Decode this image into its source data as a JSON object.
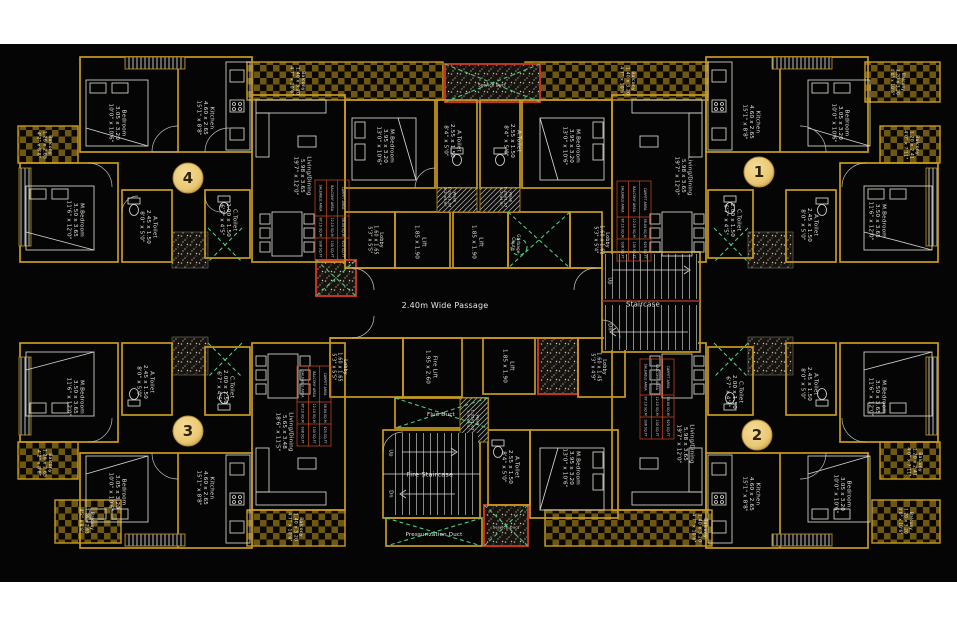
{
  "colors": {
    "canvas": "#050505",
    "wall_gold": "#c89a20",
    "wall_dark": "#8a6614",
    "checker": "#6e5712",
    "accent_red": "#c03522",
    "accent_green": "#4ec97d",
    "badge_fill": "#e9c874",
    "badge_edge": "#b4893a",
    "badge_text": "#30230a",
    "label_text": "#e7e7e1",
    "table_border": "#cf4a1e"
  },
  "badges": [
    {
      "name": "unit-badge-1",
      "label": "1",
      "x": 759,
      "y": 172
    },
    {
      "name": "unit-badge-2",
      "label": "2",
      "x": 757,
      "y": 435
    },
    {
      "name": "unit-badge-3",
      "label": "3",
      "x": 188,
      "y": 431
    },
    {
      "name": "unit-badge-4",
      "label": "4",
      "x": 188,
      "y": 178
    }
  ],
  "labels": [
    {
      "name": "u4-bedroom-label",
      "x": 118,
      "y": 123,
      "rot": 90,
      "lines": [
        "Bedroom",
        "3.05 x 3.20",
        "10'0\" x 10'6\""
      ]
    },
    {
      "name": "u4-kitchen-label",
      "x": 206,
      "y": 118,
      "rot": 90,
      "lines": [
        "Kitchen",
        "4.60 x 2.65",
        "15'1\" x 8'8\""
      ]
    },
    {
      "name": "u4-mbedroom-label",
      "x": 76,
      "y": 220,
      "rot": 90,
      "lines": [
        "M.Bedroom",
        "3.50 x 3.65",
        "11'6\" x 12'0\""
      ]
    },
    {
      "name": "u4-atoilet-label",
      "x": 149,
      "y": 227,
      "rot": 90,
      "lines": [
        "A.Toilet",
        "2.45 x 1.50",
        "8'0\" x 5'0\""
      ]
    },
    {
      "name": "u4-ctoilet-label",
      "x": 229,
      "y": 220,
      "rot": 90,
      "lines": [
        "C.Toilet",
        "2.00 x 1.50",
        "6'7\" x 4'5\""
      ]
    },
    {
      "name": "u4-living-label",
      "x": 303,
      "y": 176,
      "rot": 90,
      "lines": [
        "Living/Dining",
        "5.98 x 3.65",
        "19'7\" x 12'0\""
      ]
    },
    {
      "name": "u4-balcony-left-label",
      "x": 45,
      "y": 145,
      "rot": 90,
      "size": 4.6,
      "lines": [
        "Balcony",
        "1.26 x 2.65",
        "4'2\" x 8'8\""
      ]
    },
    {
      "name": "u4-balcony-top-label",
      "x": 298,
      "y": 81,
      "rot": 90,
      "size": 4.6,
      "lines": [
        "Balcony",
        "1.40 x 3.20",
        "4'7\" x 10'6\""
      ]
    },
    {
      "name": "u4-mbedroom2-label",
      "x": 386,
      "y": 146,
      "rot": 90,
      "lines": [
        "M.Bedroom",
        "3.95 x 3.20",
        "13'0\" x 10'6\""
      ]
    },
    {
      "name": "u4-atoilet2-label",
      "x": 453,
      "y": 141,
      "rot": 90,
      "lines": [
        "A.Toilet",
        "2.55 x 1.50",
        "8'4\" x 5'0\""
      ]
    },
    {
      "name": "wash-top-left-label",
      "x": 450,
      "y": 197,
      "rot": 90,
      "size": 3.8,
      "lines": [
        "Wash",
        "1.20x1.37",
        "4'2\"x4'6\""
      ]
    },
    {
      "name": "wash-top-right-label",
      "x": 506,
      "y": 197,
      "rot": 90,
      "size": 3.8,
      "lines": [
        "Wash",
        "1.20x1.37",
        "4'2\"x4'6\""
      ]
    },
    {
      "name": "lobby-top-left-label",
      "x": 376,
      "y": 240,
      "rot": 90,
      "size": 4.8,
      "lines": [
        "Lobby",
        "1.60 x 1.65",
        "5'3\" x 5'5\""
      ]
    },
    {
      "name": "lift-1-label",
      "x": 421,
      "y": 242,
      "rot": 90,
      "lines": [
        "Lift",
        "1.85 x 1.90"
      ]
    },
    {
      "name": "lift-2-label",
      "x": 478,
      "y": 242,
      "rot": 90,
      "lines": [
        "Lift",
        "1.85 x 1.90"
      ]
    },
    {
      "name": "garbage-chute-label",
      "x": 516,
      "y": 244,
      "rot": 90,
      "size": 4.2,
      "lines": [
        "Garbage",
        "Chute"
      ]
    },
    {
      "name": "lobby-top-right-label",
      "x": 602,
      "y": 240,
      "rot": 90,
      "size": 4.8,
      "lines": [
        "Lobby",
        "1.60 x 1.62",
        "5'3\" x 5'4\""
      ]
    },
    {
      "name": "staircase-label",
      "x": 643,
      "y": 304,
      "rot": 0,
      "size": 7,
      "lines": [
        "Staircase"
      ]
    },
    {
      "name": "staircase-up-label",
      "x": 610,
      "y": 281,
      "rot": 90,
      "size": 5,
      "lines": [
        "Up"
      ]
    },
    {
      "name": "staircase-dn-label",
      "x": 610,
      "y": 327,
      "rot": 90,
      "size": 5,
      "lines": [
        "Dn"
      ]
    },
    {
      "name": "passage-label",
      "x": 445,
      "y": 305,
      "rot": 0,
      "size": 8,
      "lines": [
        "2.40m Wide Passage"
      ]
    },
    {
      "name": "service-duct-top-label",
      "x": 492,
      "y": 85,
      "rot": 0,
      "size": 4,
      "lines": [
        "Service Duct"
      ]
    },
    {
      "name": "u1-kitchen-label",
      "x": 752,
      "y": 122,
      "rot": 90,
      "lines": [
        "Kitchen",
        "4.60 x 2.65",
        "15'1\" x 8'8\""
      ]
    },
    {
      "name": "u1-bedroom-label",
      "x": 841,
      "y": 123,
      "rot": 90,
      "lines": [
        "Bedroom",
        "3.05 x 3.20",
        "10'0\" x 10'6\""
      ]
    },
    {
      "name": "u1-mbedroom-label",
      "x": 878,
      "y": 221,
      "rot": 90,
      "lines": [
        "M.Bedroom",
        "3.50 x 3.65",
        "11'6\" x 12'0\""
      ]
    },
    {
      "name": "u1-atoilet-label",
      "x": 810,
      "y": 225,
      "rot": 90,
      "lines": [
        "A.Toilet",
        "2.45 x 1.50",
        "8'0\" x 5'0\""
      ]
    },
    {
      "name": "u1-ctoilet-label",
      "x": 733,
      "y": 220,
      "rot": 90,
      "lines": [
        "C.Toilet",
        "2.00 x 1.50",
        "6'7\" x 4'5\""
      ]
    },
    {
      "name": "u1-living-label",
      "x": 684,
      "y": 176,
      "rot": 90,
      "lines": [
        "Living/Dining",
        "5.98 x 3.65",
        "19'7\" x 12'0\""
      ]
    },
    {
      "name": "u1-balcony-right-label",
      "x": 912,
      "y": 145,
      "rot": 90,
      "size": 4.6,
      "lines": [
        "Balcony",
        "1.20 x 2.41",
        "4'0\" x 7'11\""
      ]
    },
    {
      "name": "u1-balcony-top-label",
      "x": 628,
      "y": 81,
      "rot": 90,
      "size": 4.6,
      "lines": [
        "Balcony",
        "1.40 x 3.20",
        "4'7\" x 10'6\""
      ]
    },
    {
      "name": "u1-balcony-corner-label",
      "x": 898,
      "y": 82,
      "rot": 90,
      "size": 4.2,
      "lines": [
        "Balcony",
        "1.20 x 3.20",
        "4'0\" x 10'6\""
      ]
    },
    {
      "name": "u1-mbedroom2-label",
      "x": 572,
      "y": 146,
      "rot": 90,
      "lines": [
        "M.Bedroom",
        "3.95 x 3.20",
        "13'0\" x 10'6\""
      ]
    },
    {
      "name": "u1-atoilet2-label",
      "x": 513,
      "y": 141,
      "rot": 90,
      "lines": [
        "A.Toilet",
        "2.55 x 1.50",
        "8'4\" x 5'0\""
      ]
    },
    {
      "name": "lobby-bottom-left-label",
      "x": 340,
      "y": 367,
      "rot": 90,
      "size": 4.8,
      "lines": [
        "Lobby",
        "1.60 x 1.65",
        "5'3\" x 5'5\""
      ]
    },
    {
      "name": "fire-lift-label",
      "x": 432,
      "y": 367,
      "rot": 90,
      "lines": [
        "Fire Lift",
        "1.95 x 2.60"
      ]
    },
    {
      "name": "lift-3-label",
      "x": 509,
      "y": 366,
      "rot": 90,
      "lines": [
        "Lift",
        "1.85 x 1.90"
      ]
    },
    {
      "name": "lobby-bottom-right-label",
      "x": 599,
      "y": 367,
      "rot": 90,
      "size": 4.8,
      "lines": [
        "Lobby",
        "1.60 x 1.45",
        "5'3\" x 4'9\""
      ]
    },
    {
      "name": "flue-duct-label",
      "x": 441,
      "y": 414,
      "rot": 0,
      "size": 5.5,
      "lines": [
        "Flue Duct"
      ]
    },
    {
      "name": "wash-bottom-label",
      "x": 473,
      "y": 420,
      "rot": 90,
      "size": 3.8,
      "lines": [
        "Wash",
        "1.35x1.63",
        "4'5\"x5'4\""
      ]
    },
    {
      "name": "fire-staircase-label",
      "x": 430,
      "y": 474,
      "rot": 0,
      "size": 6.5,
      "lines": [
        "Fire Staircase"
      ]
    },
    {
      "name": "fire-staircase-up-label",
      "x": 391,
      "y": 453,
      "rot": 90,
      "size": 5,
      "lines": [
        "Up"
      ]
    },
    {
      "name": "fire-staircase-dn-label",
      "x": 391,
      "y": 494,
      "rot": 90,
      "size": 5,
      "lines": [
        "Dn"
      ]
    },
    {
      "name": "pressurization-duct-label",
      "x": 434,
      "y": 534,
      "rot": 0,
      "size": 5.5,
      "lines": [
        "Pressurization Duct"
      ]
    },
    {
      "name": "service-duct-bottom-label",
      "x": 506,
      "y": 527,
      "rot": 0,
      "size": 3.8,
      "lines": [
        "Service Duct"
      ]
    },
    {
      "name": "u2-atoilet2-label",
      "x": 511,
      "y": 467,
      "rot": 90,
      "lines": [
        "A.Toilet",
        "2.55 x 1.50",
        "8'4\" x 5'0\""
      ]
    },
    {
      "name": "u2-mbedroom2-label",
      "x": 572,
      "y": 468,
      "rot": 90,
      "lines": [
        "M.Bedroom",
        "3.95 x 3.20",
        "13'0\" x 10'6\""
      ]
    },
    {
      "name": "u2-ctoilet-label",
      "x": 735,
      "y": 392,
      "rot": 90,
      "lines": [
        "C.Toilet",
        "2.00 x 1.50",
        "6'7\" x 4'5\""
      ]
    },
    {
      "name": "u2-atoilet-label",
      "x": 810,
      "y": 384,
      "rot": 90,
      "lines": [
        "A.Toilet",
        "2.45 x 1.50",
        "8'0\" x 5'0\""
      ]
    },
    {
      "name": "u2-mbedroom-label",
      "x": 878,
      "y": 397,
      "rot": 90,
      "lines": [
        "M.Bedroom",
        "3.50 x 3.65",
        "11'6\" x 12'0\""
      ]
    },
    {
      "name": "u2-bedroom-label",
      "x": 843,
      "y": 494,
      "rot": 90,
      "lines": [
        "Bedroom",
        "3.05 x 3.20",
        "10'0\" x 10'6\""
      ]
    },
    {
      "name": "u2-kitchen-label",
      "x": 752,
      "y": 494,
      "rot": 90,
      "lines": [
        "Kitchen",
        "4.60 x 2.65",
        "15'1\" x 8'8\""
      ]
    },
    {
      "name": "u2-living-label",
      "x": 686,
      "y": 444,
      "rot": 90,
      "lines": [
        "Living/Dining",
        "5.98 x 3.65",
        "19'7\" x 12'0\""
      ]
    },
    {
      "name": "u2-balcony-right-label",
      "x": 915,
      "y": 462,
      "rot": 90,
      "size": 4.6,
      "lines": [
        "Balcony",
        "1.20 x 2.41",
        "4'0\" x 7'11\""
      ]
    },
    {
      "name": "u2-balcony-bottom-label",
      "x": 700,
      "y": 528,
      "rot": 90,
      "size": 4.6,
      "lines": [
        "Balcony",
        "1.40 x 3.20",
        "4'7\" x 10'6\""
      ]
    },
    {
      "name": "u2-balcony-corner-label",
      "x": 906,
      "y": 521,
      "rot": 90,
      "size": 4.2,
      "lines": [
        "Balcony",
        "1.20 x 3.20",
        "4'0\" x 10'6\""
      ]
    },
    {
      "name": "u3-mbedroom-label",
      "x": 76,
      "y": 397,
      "rot": 90,
      "lines": [
        "M.Bedroom",
        "3.50 x 3.65",
        "11'6\" x 12'0\""
      ]
    },
    {
      "name": "u3-atoilet-label",
      "x": 146,
      "y": 382,
      "rot": 90,
      "lines": [
        "A.Toilet",
        "2.45 x 1.50",
        "8'0\" x 5'0\""
      ]
    },
    {
      "name": "u3-ctoilet-label",
      "x": 226,
      "y": 387,
      "rot": 90,
      "lines": [
        "C.Toilet",
        "2.00 x 1.50",
        "6'7\" x 4'5\""
      ]
    },
    {
      "name": "u3-bedroom-label",
      "x": 118,
      "y": 492,
      "rot": 90,
      "lines": [
        "Bedroom",
        "3.05 x 3.20",
        "10'0\" x 10'6\""
      ]
    },
    {
      "name": "u3-kitchen-label",
      "x": 206,
      "y": 488,
      "rot": 90,
      "lines": [
        "Kitchen",
        "4.60 x 2.65",
        "15'1\" x 8'8\""
      ]
    },
    {
      "name": "u3-living-label",
      "x": 285,
      "y": 432,
      "rot": 90,
      "lines": [
        "Living/Dining",
        "5.65 x 3.48",
        "18'6\" x 11'5\""
      ]
    },
    {
      "name": "u3-balcony-left-label",
      "x": 45,
      "y": 463,
      "rot": 90,
      "size": 4.6,
      "lines": [
        "Balcony",
        "1.26 x 2.65",
        "4'2\" x 8'8\""
      ]
    },
    {
      "name": "u3-balcony-bottom-label",
      "x": 296,
      "y": 527,
      "rot": 90,
      "size": 4.6,
      "lines": [
        "Balcony",
        "1.40 x 3.20",
        "4'7\" x 10'6\""
      ]
    },
    {
      "name": "u3-balcony-corner-label",
      "x": 87,
      "y": 521,
      "rot": 90,
      "size": 4.2,
      "lines": [
        "Balcony",
        "1.26 x 2.65",
        "4'2\" x 8'8\""
      ]
    }
  ],
  "area_tables": {
    "rows": [
      {
        "label": "CARPET AREA",
        "sqm": "58.04 SQ.M",
        "sqft": "625 SQ.FT"
      },
      {
        "label": "BALCONY AREA",
        "sqm": "12.10 SQ.M",
        "sqft": "130 SQ.FT"
      },
      {
        "label": "SALEABLE AREA",
        "sqm": "87.10 SQ.M",
        "sqft": "938 SQ.FT"
      }
    ],
    "positions": [
      {
        "name": "area-table-unit4",
        "x": 332,
        "y": 220
      },
      {
        "name": "area-table-unit1",
        "x": 634,
        "y": 221
      },
      {
        "name": "area-table-unit3",
        "x": 314,
        "y": 406
      },
      {
        "name": "area-table-unit2",
        "x": 657,
        "y": 399
      }
    ]
  }
}
